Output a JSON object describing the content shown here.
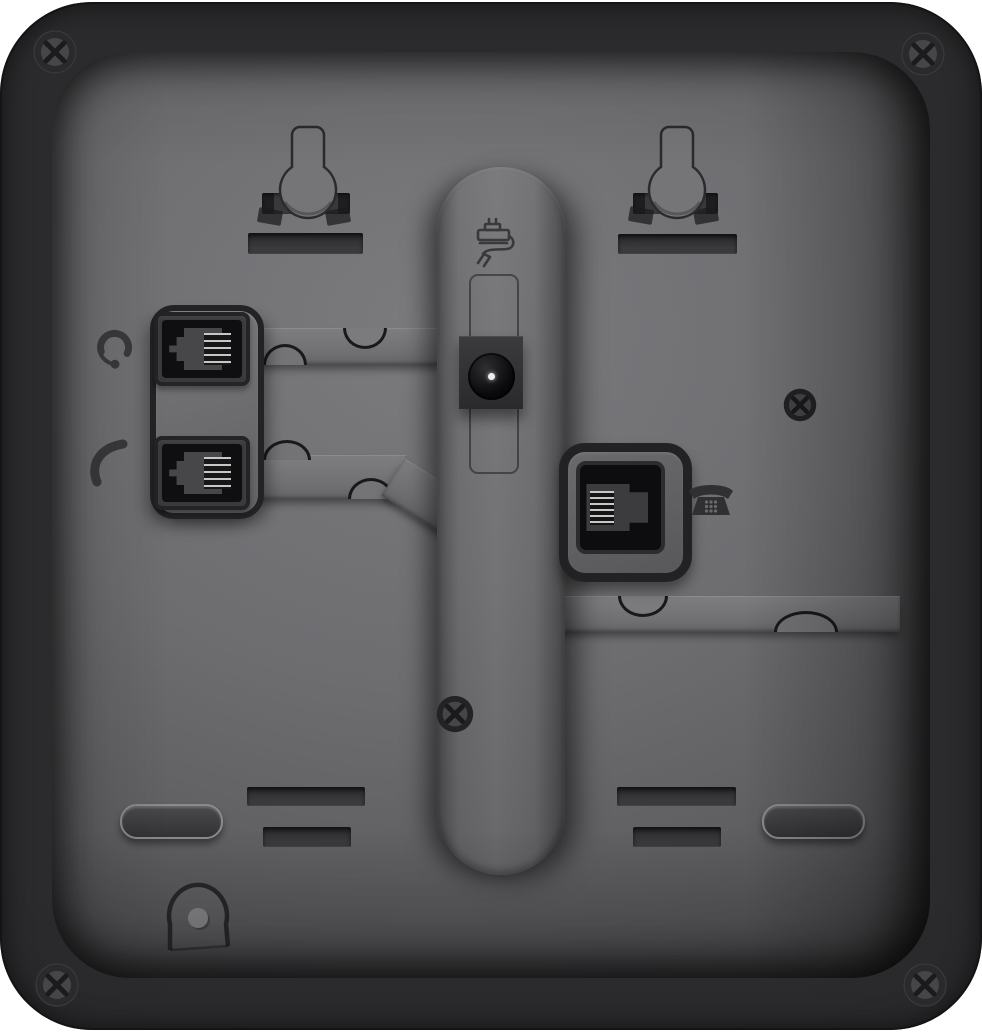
{
  "meta": {
    "type": "product-photo",
    "subject": "rear panel of a black desk telephone",
    "visible_text": "none"
  },
  "colors": {
    "page_bg": "#ffffff",
    "shell": "#232325",
    "panel_mid": "#6c6c6f",
    "panel_light": "#7a7a7d",
    "panel_dark": "#404043",
    "recess": "#333335",
    "cavity_black": "#0e0e10",
    "connector_pins": "#c6c8c3",
    "icon_glyph": "#3a3a3c",
    "screw_head": "#47474b",
    "power_pin": "#ecece9"
  },
  "ports": {
    "headset": {
      "icon": "headset-icon",
      "label": "headset jack"
    },
    "handset": {
      "icon": "handset-icon",
      "label": "handset jack"
    },
    "power": {
      "icon": "power-adapter-icon",
      "label": "DC power jack"
    },
    "line": {
      "icon": "desk-phone-icon",
      "label": "phone line jack"
    }
  },
  "features": {
    "wall_mount_keyholes": 2,
    "keyhole_slot_plates": 2,
    "top_mounting_slots": 2,
    "bottom_mounting_slots": 4,
    "rubber_feet": 2,
    "corner_screws": 4,
    "body_screws": 2,
    "cable_channels": 3,
    "cable_clip_notches": 6,
    "handset_wall_hook": 1,
    "stand_rail": 1
  }
}
